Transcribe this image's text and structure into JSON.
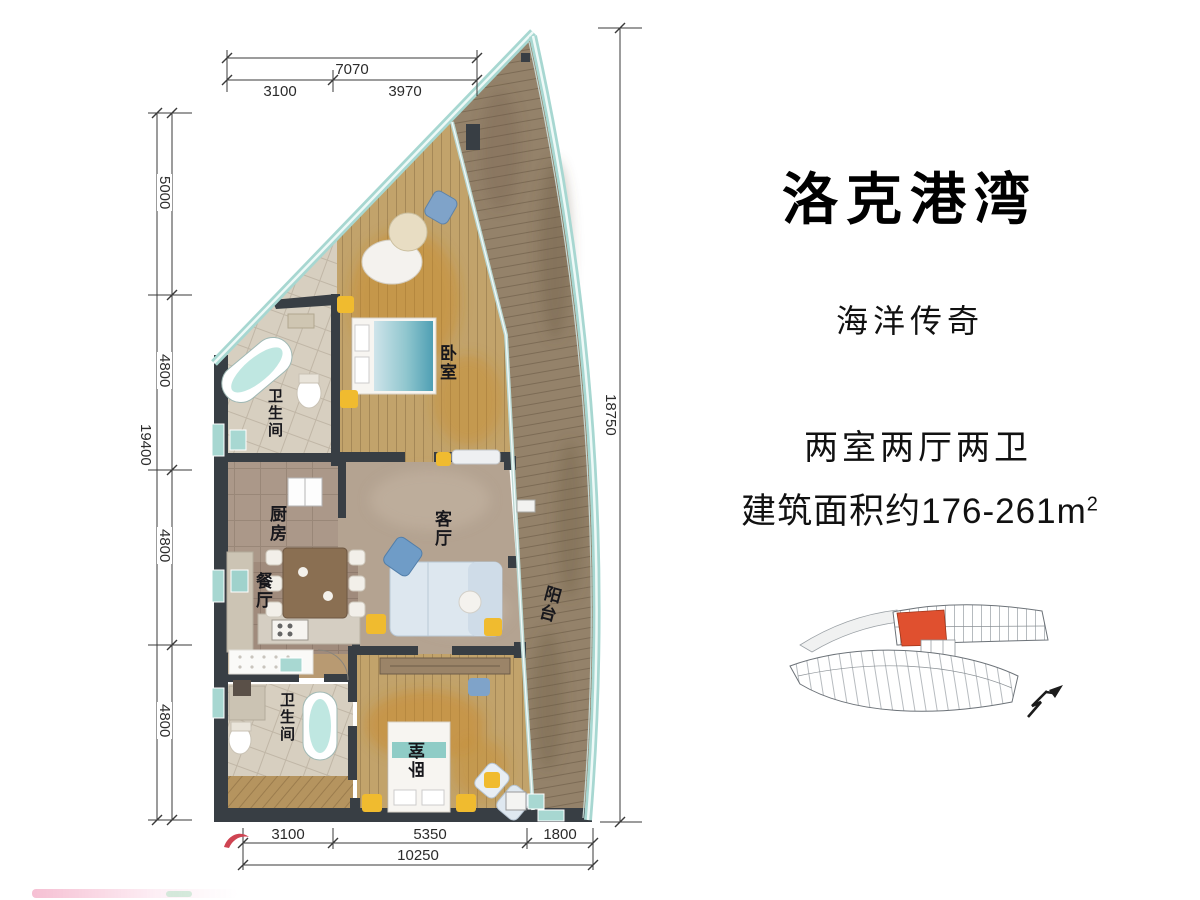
{
  "project": {
    "title": "洛克港湾",
    "subtitle": "海洋传奇",
    "layout_type": "两室两厅两卫",
    "area_prefix": "建筑面积约176-261m",
    "area_superscript": "2"
  },
  "rooms": {
    "bedroom_top": "卧室",
    "bathroom_top": "卫生间",
    "kitchen": "厨房",
    "dining": "餐厅",
    "living": "客厅",
    "balcony": "阳台",
    "bathroom_bottom": "卫生间",
    "bedroom_bottom": "卧室"
  },
  "dimensions": {
    "top_total": "7070",
    "top_segments": [
      "3100",
      "3970"
    ],
    "left_total": "19400",
    "left_segments": [
      "5000",
      "4800",
      "4800",
      "4800"
    ],
    "right_total": "18750",
    "bottom_segments": [
      "3100",
      "5350",
      "1800"
    ],
    "bottom_total": "10250"
  },
  "colors": {
    "wall": "#383e44",
    "glass": "#a7d7d1",
    "wood": "#c2a36b",
    "accent_yellow": "#f0bb2f",
    "accent_blue": "#7fa3c9",
    "highlight_unit": "#e0502f"
  }
}
